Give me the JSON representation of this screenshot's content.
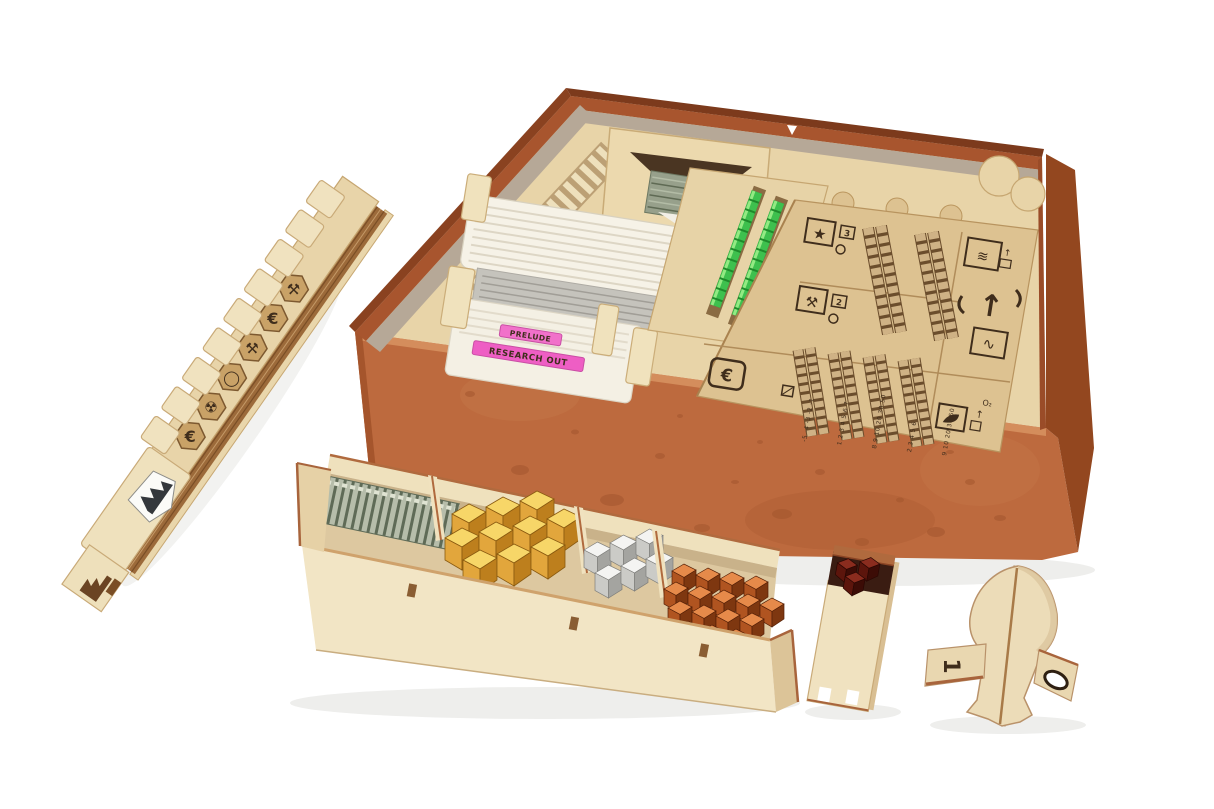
{
  "photo": {
    "subject": "Laser-cut wooden organizer insert for a Mars-themed board game box, loaded with cards, hex tiles, player boards and metallic resource cubes",
    "background_color": "#ffffff"
  },
  "palette": {
    "box_copper": "#bd6a3e",
    "box_copper_dark": "#93471f",
    "box_liner_gray": "#b6a897",
    "wood_cream": "#eee0bc",
    "wood_tan": "#ddc291",
    "engraving": "#3f2d1c",
    "plywood_edge": "#9c6a3a",
    "green_cube": "#3ec04e",
    "gold_cube": "#e2a63c",
    "silver_cube": "#cbcbc7",
    "copper_cube": "#b05420",
    "dark_red_cube": "#5c150c",
    "pink_tab": "#ee5ec4",
    "card_white": "#f6f2e7",
    "card_gray": "#c5c3bc"
  },
  "organizer_board": {
    "cells": {
      "score": {
        "glyph": "★",
        "value": "3"
      },
      "build": {
        "glyph": "⚒",
        "value": "2"
      },
      "credit": {
        "glyph": "€"
      },
      "ocean": {
        "glyph": "≋",
        "arrow": "↑"
      },
      "raise": {
        "glyph": "↑"
      },
      "power": {
        "glyph": "∿"
      },
      "oxygen": {
        "label": "O₂",
        "arrow": "↑"
      }
    },
    "tracks": {
      "t1": "-5 -4 -3 -2 -1",
      "t2": "1 2 3 4 5 6 7",
      "t3": "8 9 10 20 30 50",
      "t4": "2 3 4 5 6",
      "t5": "9 10 20 30 50"
    }
  },
  "card_trays": {
    "divider_tabs": [
      {
        "label": "PRELUDE"
      },
      {
        "label": "RESEARCH OUT"
      }
    ]
  },
  "player_board_stack": {
    "hex_tile_icons": [
      "€",
      "☢",
      "◯",
      "⚒",
      "€",
      "⚒"
    ],
    "steps": 9
  },
  "resource_tray": {
    "compartments": [
      "hex tiles",
      "gold cubes",
      "silver cubes",
      "copper cubes"
    ]
  },
  "cube_box": {
    "contents": "dark red cubes"
  },
  "first_player_marker": {
    "shape": "rocket",
    "number": "1",
    "fin_cutout": "oval"
  },
  "counts": {
    "green_cube_columns": 3,
    "gold_cubes": 10,
    "silver_cubes": 6,
    "copper_cubes": 16,
    "dark_red_cubes": 3
  }
}
